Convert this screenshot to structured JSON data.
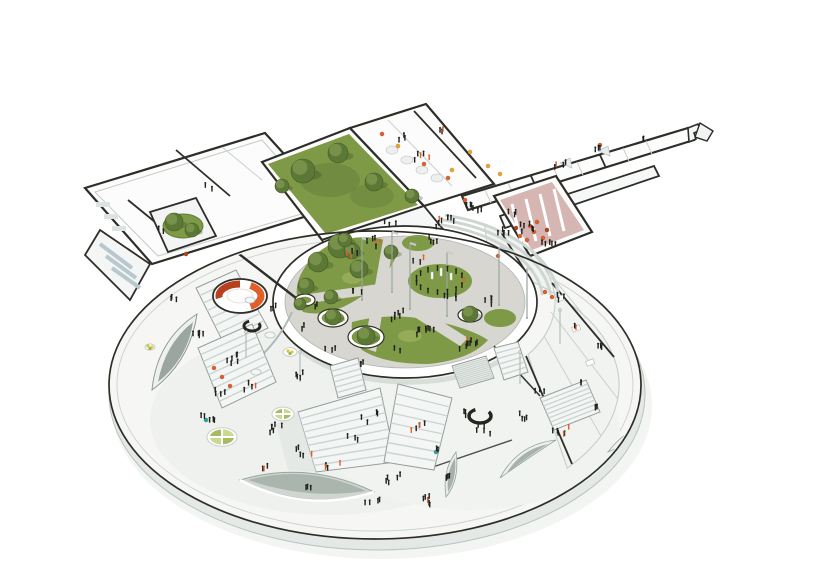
{
  "meta": {
    "title": "Architectural axonometric cutaway rendering",
    "subject": "Circular school building with central elevated garden courtyard, rooftop lawn, library wing, canteen wing, entry corridor, pink assembly hall, ring classrooms and sunken plaza with skylights",
    "view": "aerial axonometric",
    "background": "white"
  },
  "palette": {
    "outline": "#2e2e28",
    "platform_top": "#f6f7f5",
    "platform_side": "#e4e8e6",
    "paving": "#d8d6d0",
    "lawn": "#7f9a46",
    "lawn_light": "#95ab5a",
    "lawn_dark": "#62793a",
    "tree": "#5b7836",
    "tree_light": "#7d954e",
    "accent_orange": "#e05f2b",
    "accent_red": "#b8401e",
    "accent_pink": "#cfa9a5",
    "accent_yellow": "#eba433",
    "accent_yellow_green": "#c9d035",
    "people": "#20201d",
    "wall_shade": "#ccd4d1",
    "glass_shade": "#b9c8cd"
  },
  "scene": {
    "trees": [
      [
        318,
        262,
        10
      ],
      [
        340,
        246,
        12
      ],
      [
        359,
        269,
        9
      ],
      [
        306,
        286,
        8
      ],
      [
        331,
        297,
        7
      ],
      [
        333,
        317,
        8
      ],
      [
        366,
        336,
        9
      ],
      [
        391,
        252,
        7
      ],
      [
        470,
        314,
        8
      ],
      [
        352,
        251,
        8
      ],
      [
        303,
        171,
        12
      ],
      [
        338,
        153,
        10
      ],
      [
        374,
        182,
        9
      ],
      [
        412,
        196,
        7
      ],
      [
        282,
        186,
        7
      ],
      [
        174,
        222,
        9
      ],
      [
        192,
        230,
        7
      ],
      [
        345,
        240,
        7
      ],
      [
        300,
        304,
        6
      ]
    ],
    "ring_planters": [
      [
        333,
        318,
        15,
        9
      ],
      [
        366,
        337,
        18,
        11
      ],
      [
        305,
        300,
        10,
        6
      ],
      [
        470,
        315,
        12,
        7
      ]
    ],
    "people_ring": {
      "cx": 440,
      "cy": 281,
      "rx": 24,
      "ry": 12,
      "count": 15
    },
    "people_groups": [
      [
        400,
        318,
        6,
        10
      ],
      [
        425,
        333,
        8,
        9
      ],
      [
        468,
        347,
        9,
        10
      ],
      [
        356,
        292,
        3,
        6
      ],
      [
        452,
        300,
        4,
        8
      ],
      [
        492,
        304,
        4,
        7
      ],
      [
        418,
        262,
        3,
        7
      ],
      [
        372,
        247,
        3,
        6
      ],
      [
        448,
        226,
        8,
        12
      ],
      [
        474,
        212,
        6,
        9
      ],
      [
        504,
        232,
        5,
        8
      ],
      [
        430,
        243,
        4,
        7
      ],
      [
        390,
        225,
        3,
        6
      ],
      [
        420,
        160,
        5,
        10
      ],
      [
        400,
        140,
        3,
        6
      ],
      [
        445,
        135,
        3,
        6
      ],
      [
        560,
        168,
        4,
        7
      ],
      [
        600,
        152,
        3,
        5
      ],
      [
        640,
        140,
        2,
        4
      ],
      [
        528,
        230,
        6,
        9
      ],
      [
        548,
        246,
        5,
        8
      ],
      [
        512,
        215,
        3,
        5
      ],
      [
        560,
        300,
        3,
        5
      ],
      [
        575,
        330,
        2,
        4
      ],
      [
        600,
        350,
        3,
        5
      ],
      [
        585,
        385,
        2,
        4
      ],
      [
        162,
        232,
        2,
        4
      ],
      [
        208,
        190,
        2,
        4
      ],
      [
        350,
        255,
        4,
        8
      ],
      [
        378,
        243,
        3,
        6
      ],
      [
        176,
        302,
        3,
        6
      ],
      [
        200,
        338,
        5,
        9
      ],
      [
        232,
        362,
        6,
        10
      ],
      [
        252,
        390,
        4,
        8
      ],
      [
        206,
        420,
        5,
        9
      ],
      [
        280,
        430,
        6,
        10
      ],
      [
        305,
        455,
        5,
        9
      ],
      [
        332,
        470,
        4,
        8
      ],
      [
        262,
        470,
        3,
        6
      ],
      [
        352,
        440,
        3,
        6
      ],
      [
        392,
        482,
        5,
        9
      ],
      [
        424,
        502,
        7,
        10
      ],
      [
        452,
        482,
        4,
        8
      ],
      [
        484,
        432,
        5,
        9
      ],
      [
        520,
        420,
        4,
        8
      ],
      [
        560,
        432,
        6,
        9
      ],
      [
        592,
        412,
        3,
        6
      ],
      [
        540,
        392,
        3,
        6
      ],
      [
        470,
        416,
        3,
        6
      ],
      [
        434,
        452,
        2,
        5
      ],
      [
        312,
        492,
        3,
        6
      ],
      [
        372,
        506,
        4,
        8
      ],
      [
        296,
        378,
        4,
        8
      ],
      [
        330,
        350,
        3,
        6
      ],
      [
        360,
        368,
        3,
        6
      ],
      [
        398,
        352,
        2,
        5
      ],
      [
        302,
        330,
        2,
        5
      ],
      [
        275,
        310,
        3,
        5
      ],
      [
        316,
        308,
        2,
        4
      ],
      [
        368,
        420,
        4,
        10
      ],
      [
        420,
        430,
        5,
        9
      ],
      [
        220,
        395,
        4,
        9
      ]
    ],
    "flagpoles": [
      [
        362,
        238,
        62
      ],
      [
        410,
        243,
        66
      ],
      [
        447,
        252,
        64
      ],
      [
        499,
        247,
        58
      ],
      [
        527,
        268,
        50
      ],
      [
        392,
        232,
        60
      ]
    ],
    "light_poles": [
      [
        300,
        352,
        30
      ],
      [
        520,
        352,
        32
      ],
      [
        560,
        310,
        34
      ],
      [
        246,
        332,
        26
      ]
    ],
    "quadrant_planters": [
      [
        222,
        437,
        15
      ],
      [
        283,
        414,
        11
      ]
    ],
    "dot_tables": [
      [
        290,
        352,
        7
      ],
      [
        150,
        347,
        5
      ]
    ],
    "round_tables": [
      [
        250,
        300
      ],
      [
        270,
        335
      ],
      [
        256,
        372
      ],
      [
        470,
        215
      ],
      [
        488,
        224
      ],
      [
        200,
        168
      ],
      [
        225,
        160
      ],
      [
        250,
        152
      ]
    ],
    "stairs": [
      {
        "p": [
          [
            298,
            412
          ],
          [
            380,
            388
          ],
          [
            396,
            462
          ],
          [
            316,
            472
          ]
        ],
        "n": 9
      },
      {
        "p": [
          [
            398,
            384
          ],
          [
            452,
            398
          ],
          [
            434,
            470
          ],
          [
            384,
            462
          ]
        ],
        "n": 8
      },
      {
        "p": [
          [
            196,
            288
          ],
          [
            236,
            270
          ],
          [
            268,
            328
          ],
          [
            226,
            348
          ]
        ],
        "n": 8
      },
      {
        "p": [
          [
            198,
            348
          ],
          [
            252,
            324
          ],
          [
            276,
            382
          ],
          [
            222,
            408
          ]
        ],
        "n": 9
      },
      {
        "p": [
          [
            330,
            366
          ],
          [
            358,
            358
          ],
          [
            366,
            390
          ],
          [
            338,
            398
          ]
        ],
        "n": 6
      },
      {
        "p": [
          [
            494,
            348
          ],
          [
            518,
            342
          ],
          [
            528,
            372
          ],
          [
            504,
            380
          ]
        ],
        "n": 6
      },
      {
        "p": [
          [
            540,
            398
          ],
          [
            586,
            380
          ],
          [
            600,
            412
          ],
          [
            554,
            430
          ]
        ],
        "n": 8
      },
      {
        "p": [
          [
            126,
            224
          ],
          [
            160,
            210
          ],
          [
            186,
            254
          ],
          [
            150,
            270
          ]
        ],
        "n": 6
      },
      {
        "p": [
          [
            452,
            366
          ],
          [
            486,
            356
          ],
          [
            494,
            378
          ],
          [
            460,
            388
          ]
        ],
        "n": 12
      }
    ],
    "accent_dots": {
      "orange": [
        [
          520,
          236
        ],
        [
          527,
          240
        ],
        [
          534,
          232
        ],
        [
          543,
          238
        ],
        [
          530,
          226
        ],
        [
          537,
          222
        ],
        [
          214,
          368
        ],
        [
          222,
          377
        ],
        [
          230,
          386
        ],
        [
          382,
          134
        ],
        [
          424,
          164
        ],
        [
          448,
          178
        ],
        [
          545,
          292
        ],
        [
          552,
          297
        ],
        [
          600,
          145
        ],
        [
          498,
          256
        ],
        [
          465,
          200
        ]
      ],
      "red": [
        [
          516,
          228
        ],
        [
          547,
          230
        ],
        [
          186,
          254
        ]
      ],
      "yellow": [
        [
          398,
          146
        ],
        [
          470,
          152
        ],
        [
          488,
          166
        ],
        [
          500,
          174
        ],
        [
          452,
          170
        ]
      ],
      "cyan": [
        [
          436,
          452
        ],
        [
          206,
          420
        ]
      ]
    }
  }
}
